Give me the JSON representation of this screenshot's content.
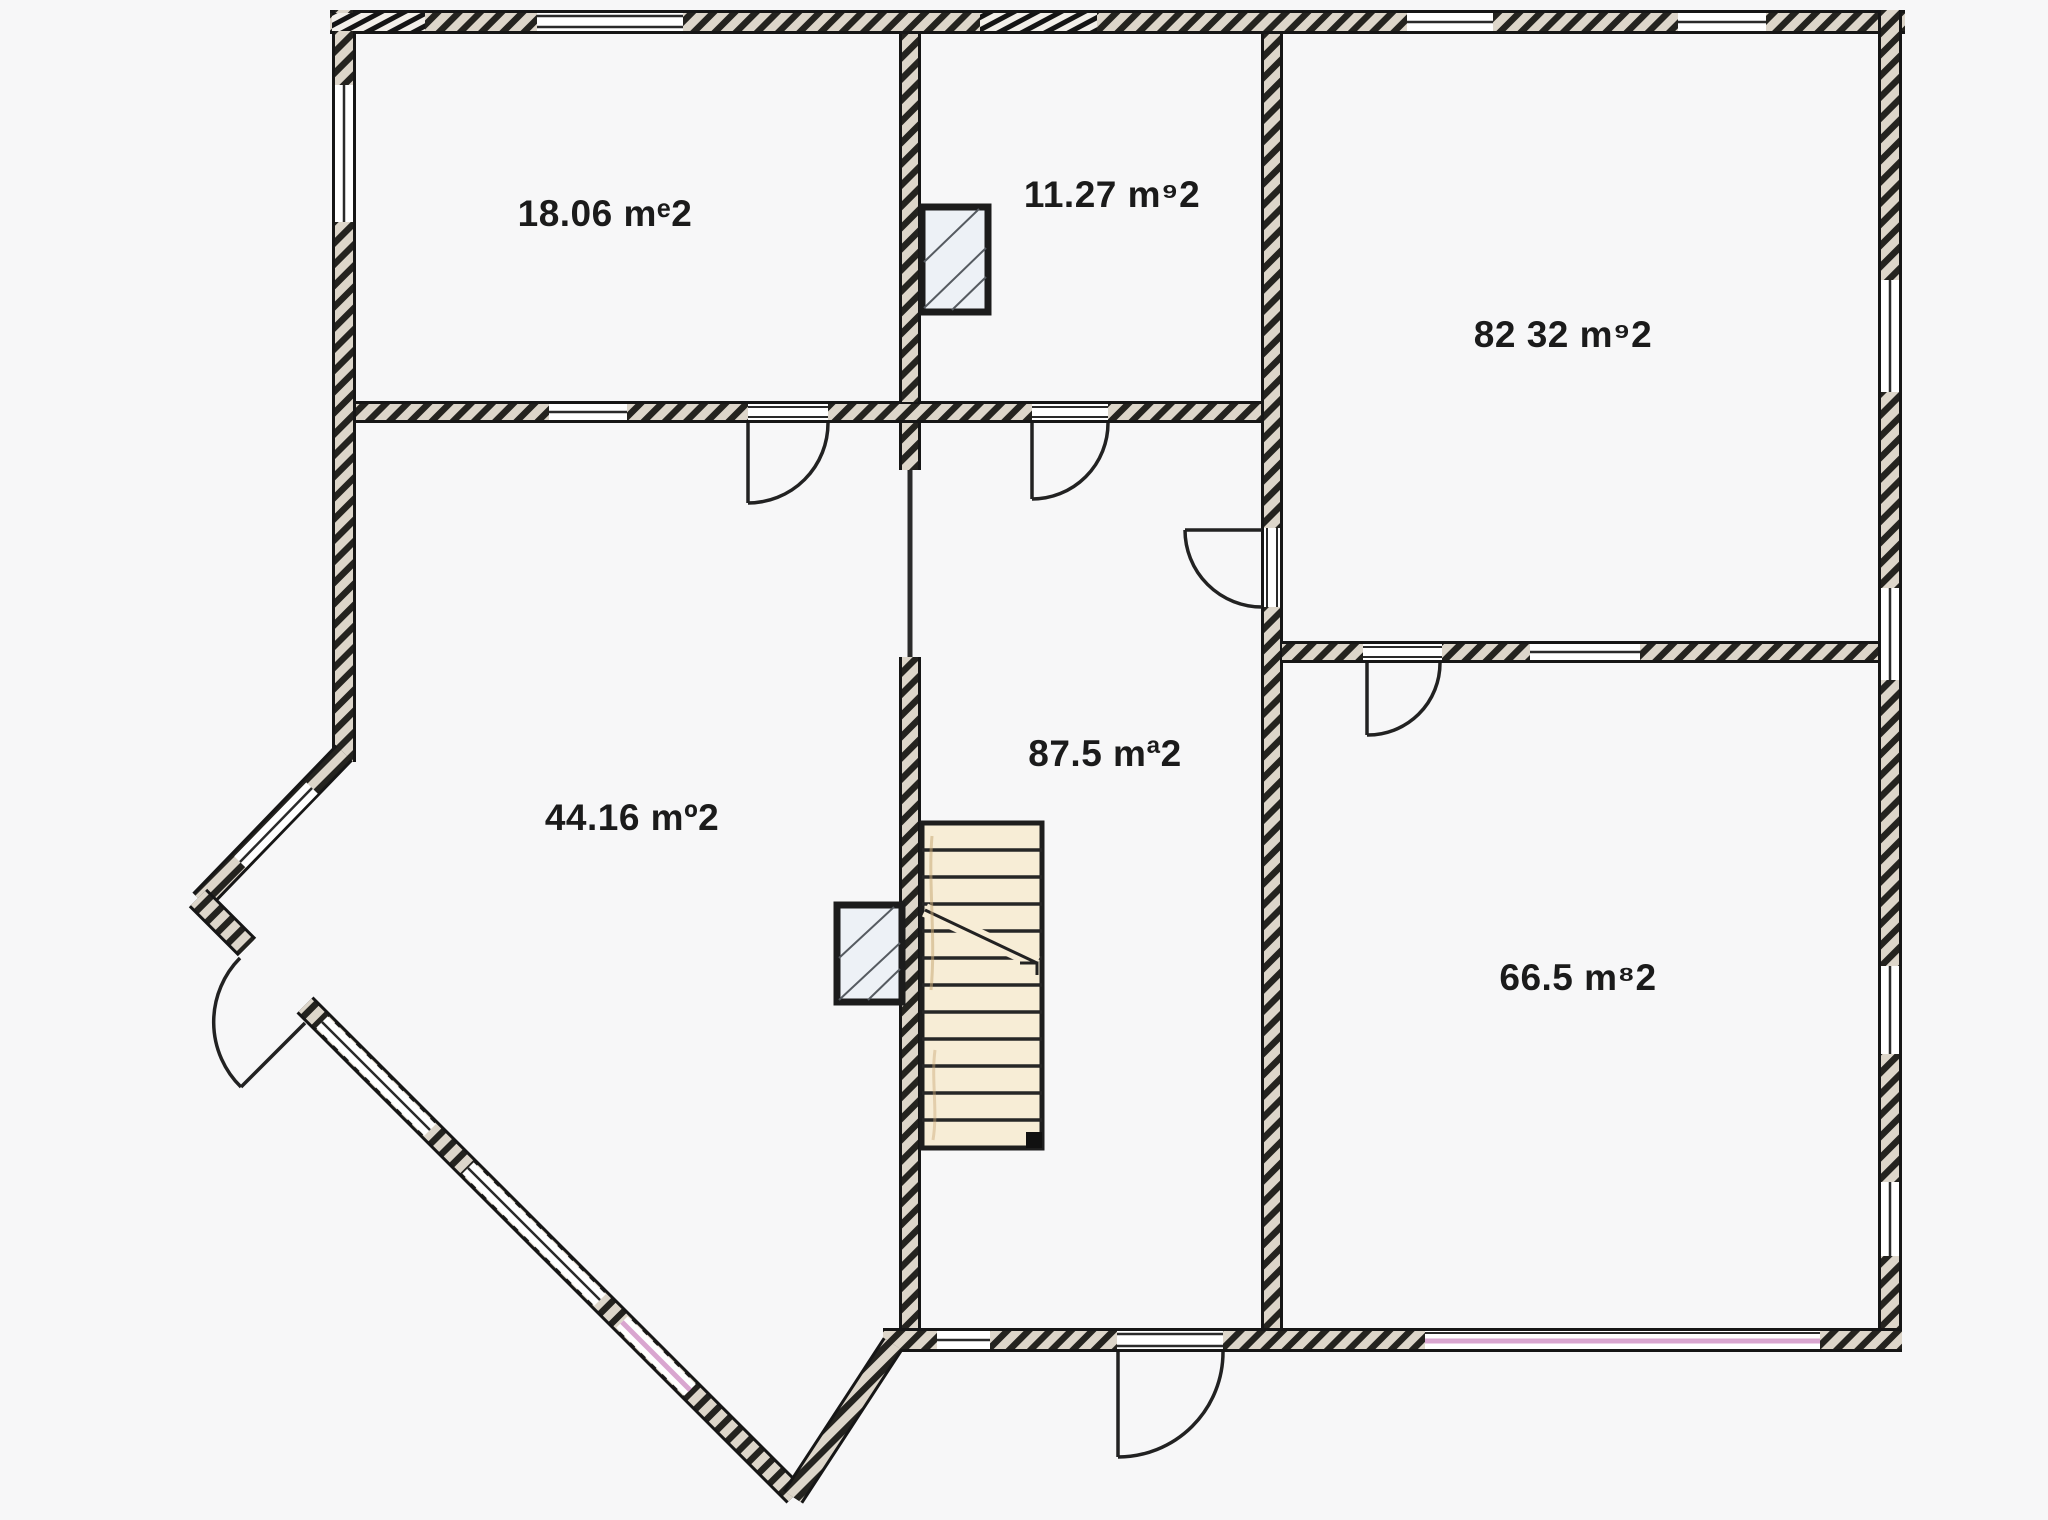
{
  "plan": {
    "type": "architectural-floor-plan",
    "view": "top-down"
  },
  "rooms": [
    {
      "name": "room-top-left",
      "area_label": "18.06 mᵉ2"
    },
    {
      "name": "room-top-middle",
      "area_label": "11.27 m⁹2"
    },
    {
      "name": "room-top-right",
      "area_label": "82 32 m⁹2"
    },
    {
      "name": "room-left",
      "area_label": "44.16 mº2"
    },
    {
      "name": "room-hallway",
      "area_label": "87.5 mª2"
    },
    {
      "name": "room-bottom-right",
      "area_label": "66.5 m⁸2"
    }
  ],
  "colors": {
    "background": "#f7f7f8",
    "wall_stripe_dark": "#24231f",
    "wall_stripe_light": "#ddd6ca",
    "wall_edge": "#161616",
    "window_fill": "#ffffff",
    "window_pink_line": "#d9a6d0",
    "stairs_fill": "#f7edd6",
    "stairs_line": "#262626",
    "shaft_fill": "#edf1f6",
    "label_text": "#1b1b1b"
  }
}
